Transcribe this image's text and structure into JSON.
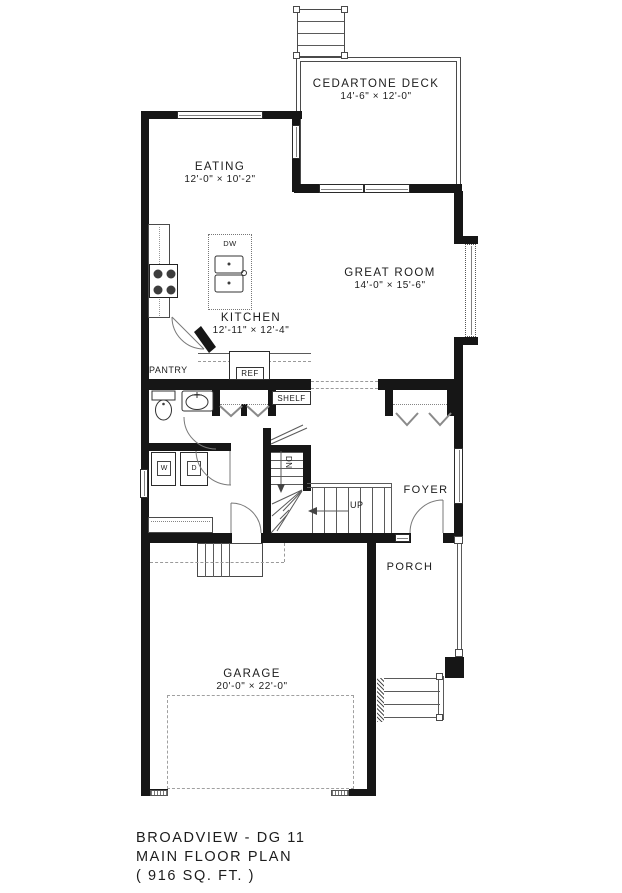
{
  "plan": {
    "rooms": {
      "deck": {
        "name": "CEDARTONE DECK",
        "dims": "14'-6\" × 12'-0\""
      },
      "eating": {
        "name": "EATING",
        "dims": "12'-0\" × 10'-2\""
      },
      "great_room": {
        "name": "GREAT ROOM",
        "dims": "14'-0\" × 15'-6\""
      },
      "kitchen": {
        "name": "KITCHEN",
        "dims": "12'-11\" × 12'-4\""
      },
      "garage": {
        "name": "GARAGE",
        "dims": "20'-0\" × 22'-0\""
      },
      "foyer": {
        "name": "FOYER"
      },
      "porch": {
        "name": "PORCH"
      },
      "pantry": {
        "name": "PANTRY"
      }
    },
    "labels": {
      "ref": "REF",
      "shelf": "SHELF",
      "dw": "DW",
      "washer": "W",
      "dryer": "D",
      "up": "UP",
      "dn": "DN"
    },
    "title": {
      "line1": "BROADVIEW - DG 11",
      "line2": "MAIN FLOOR PLAN",
      "line3": "( 916 SQ. FT. )"
    },
    "colors": {
      "wall": "#161616",
      "line": "#5a5a5a",
      "dash": "#9a9a9a"
    }
  }
}
